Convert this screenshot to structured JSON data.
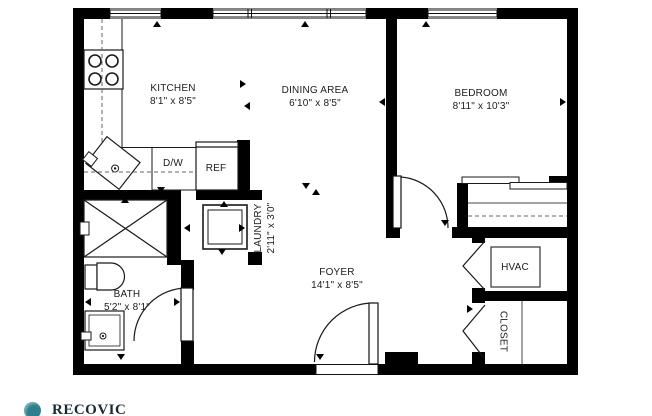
{
  "rooms": {
    "kitchen": {
      "label": "KITCHEN",
      "dims": "8'1\" x 8'5\""
    },
    "dining": {
      "label": "DINING AREA",
      "dims": "6'10\" x 8'5\""
    },
    "bedroom": {
      "label": "BEDROOM",
      "dims": "8'11\" x 10'3\""
    },
    "laundry": {
      "label": "LAUNDRY",
      "dims": "2'11\" x 3'0\""
    },
    "bath": {
      "label": "BATH",
      "dims": "5'2\" x 8'1\""
    },
    "foyer": {
      "label": "FOYER",
      "dims": "14'1\" x 8'5\""
    },
    "hvac": {
      "label": "HVAC"
    },
    "closet": {
      "label": "CLOSET"
    }
  },
  "appliances": {
    "dishwasher": "D/W",
    "refrigerator": "REF"
  },
  "branding": {
    "logo_text": "RECOVIC"
  },
  "colors": {
    "wall": "#000000",
    "line": "#1a1a1a",
    "dashed": "#666666",
    "background": "#ffffff",
    "logo_circle": "#2e7f8c",
    "logo_text": "#192a35"
  }
}
